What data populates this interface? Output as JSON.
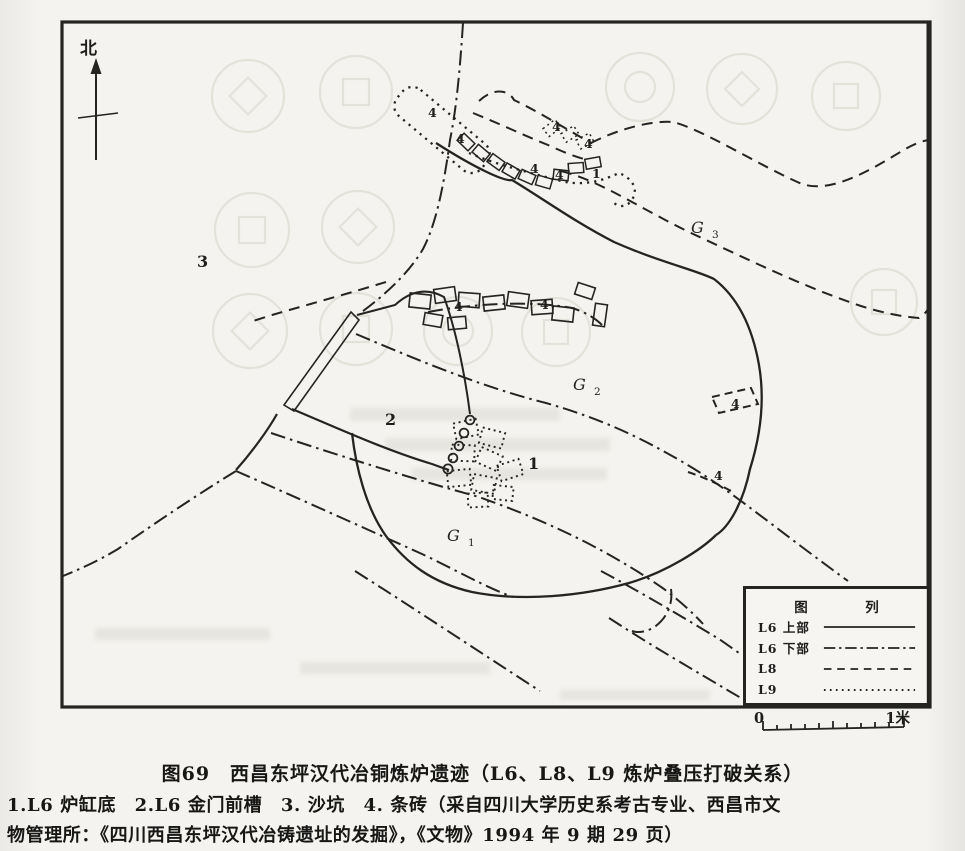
{
  "map": {
    "north_label": "北",
    "g_labels": [
      {
        "letter": "G",
        "index": "1",
        "x": 447,
        "y": 541
      },
      {
        "letter": "G",
        "index": "2",
        "x": 573,
        "y": 390
      },
      {
        "letter": "G",
        "index": "3",
        "x": 691,
        "y": 233
      }
    ],
    "labels": [
      {
        "text": "4",
        "x": 428,
        "y": 117,
        "cls": "sm"
      },
      {
        "text": "4",
        "x": 456,
        "y": 143,
        "cls": "sm"
      },
      {
        "text": "4",
        "x": 552,
        "y": 131,
        "cls": "sm"
      },
      {
        "text": "4",
        "x": 584,
        "y": 148,
        "cls": "sm"
      },
      {
        "text": "4",
        "x": 530,
        "y": 173,
        "cls": "sm"
      },
      {
        "text": "4",
        "x": 555,
        "y": 179,
        "cls": "sm"
      },
      {
        "text": "1",
        "x": 592,
        "y": 178,
        "cls": "sm"
      },
      {
        "text": "4",
        "x": 454,
        "y": 311,
        "cls": "sm"
      },
      {
        "text": "4",
        "x": 540,
        "y": 309,
        "cls": "sm"
      },
      {
        "text": "4",
        "x": 731,
        "y": 408,
        "cls": "sm"
      },
      {
        "text": "4",
        "x": 714,
        "y": 480,
        "cls": "sm"
      },
      {
        "text": "3",
        "x": 197,
        "y": 267,
        "cls": "lg"
      },
      {
        "text": "2",
        "x": 385,
        "y": 425,
        "cls": "lg"
      },
      {
        "text": "1",
        "x": 528,
        "y": 469,
        "cls": "lg"
      }
    ],
    "legend": {
      "title": "图　列",
      "rows": [
        {
          "label": "L6 上部",
          "style": "solid"
        },
        {
          "label": "L6 下部",
          "style": "dashdot"
        },
        {
          "label": "L8",
          "style": "dashed"
        },
        {
          "label": "L9",
          "style": "dotted"
        }
      ]
    },
    "scale": {
      "start": "0",
      "end": "1米"
    }
  },
  "caption": {
    "line1": "图69　西昌东坪汉代冶铜炼炉遗迹（L6、L8、L9 炼炉叠压打破关系）",
    "line2": "1.L6 炉缸底　2.L6 金门前槽　3. 沙坑　4. 条砖（采自四川大学历史系考古专业、西昌市文",
    "line3": "物管理所：《四川西昌东坪汉代冶铸遗址的发掘》，《文物》1994 年 9 期 29 页）"
  },
  "colors": {
    "ink": "#242423",
    "paper": "#f4f3ef",
    "ghost": "#d9d7cd"
  }
}
